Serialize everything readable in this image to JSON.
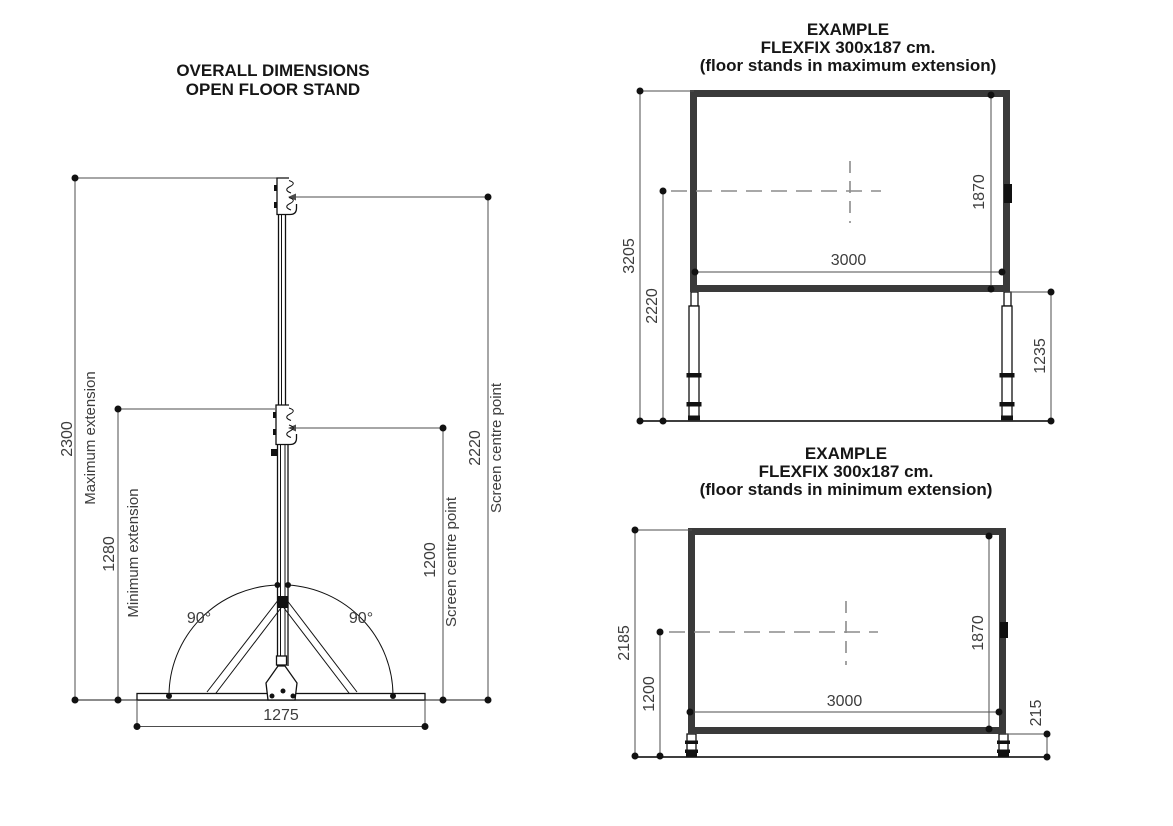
{
  "colors": {
    "background": "#ffffff",
    "ink": "#111111",
    "dimension_line": "#4d4d4d",
    "dimension_text": "#3d3d3d",
    "screen_frame": "#3a3a3a",
    "dashed_centerline": "#8c8c8c"
  },
  "left": {
    "title1": "OVERALL DIMENSIONS",
    "title2": "OPEN FLOOR STAND",
    "max_ext": {
      "value": "2300",
      "label": "Maximum extension"
    },
    "min_ext": {
      "value": "1280",
      "label": "Minimum extension"
    },
    "screen_centre_high": {
      "value": "2220",
      "label": "Screen centre point"
    },
    "screen_centre_low": {
      "value": "1200",
      "label": "Screen centre point"
    },
    "base_width": "1275",
    "angle_left": "90°",
    "angle_right": "90°"
  },
  "top_right": {
    "title1": "EXAMPLE",
    "title2": "FLEXFIX 300x187 cm.",
    "title3": "(floor stands in maximum extension)",
    "overall_height": "3205",
    "centre_height": "2220",
    "screen_height": "1870",
    "screen_width": "3000",
    "leg_height": "1235"
  },
  "bottom_right": {
    "title1": "EXAMPLE",
    "title2": "FLEXFIX 300x187 cm.",
    "title3": "(floor stands in minimum extension)",
    "overall_height": "2185",
    "centre_height": "1200",
    "screen_height": "1870",
    "screen_width": "3000",
    "leg_height": "215"
  }
}
